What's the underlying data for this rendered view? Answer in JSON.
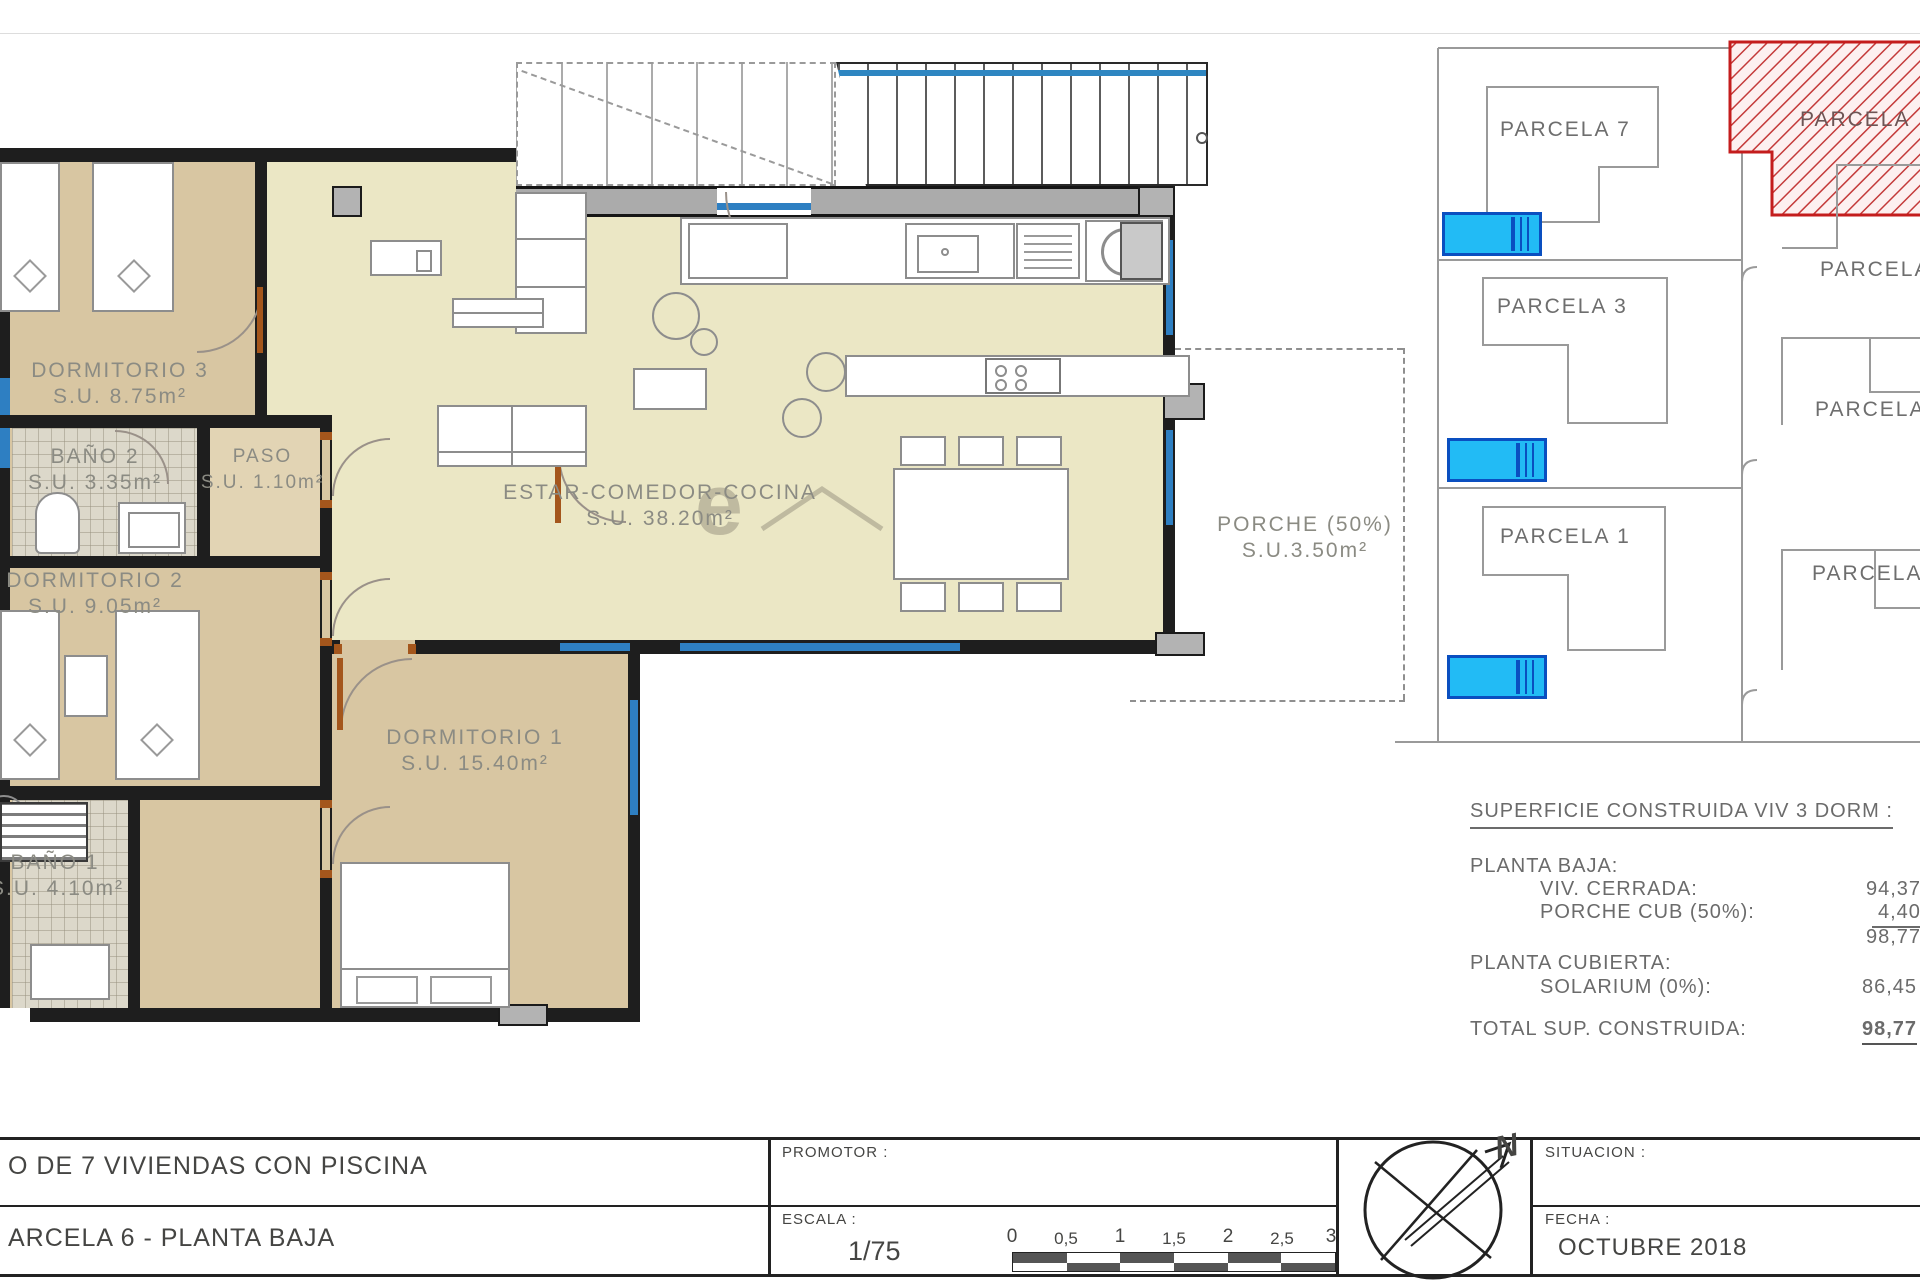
{
  "plan": {
    "rooms": {
      "dorm3": {
        "name": "DORMITORIO 3",
        "area": "S.U. 8.75m²"
      },
      "bano2": {
        "name": "BAÑO 2",
        "area": "S.U. 3.35m²"
      },
      "paso": {
        "name": "PASO",
        "area": "S.U. 1.10m²"
      },
      "dorm2": {
        "name": "DORMITORIO 2",
        "area": "S.U. 9.05m²"
      },
      "estar": {
        "name": "ESTAR-COMEDOR-COCINA",
        "area": "S.U. 38.20m²"
      },
      "porche": {
        "name": "PORCHE (50%)",
        "area": "S.U.3.50m²"
      },
      "dorm1": {
        "name": "DORMITORIO 1",
        "area": "S.U. 15.40m²"
      },
      "bano1": {
        "name": "BAÑO 1",
        "area": "S.U. 4.10m²"
      }
    },
    "watermark": "e"
  },
  "site": {
    "parcela7": "PARCELA 7",
    "parcela3": "PARCELA 3",
    "parcela1": "PARCELA 1",
    "parcela6": "PARCELA",
    "parcela5": "PARCELA",
    "parcela4": "PARCELA 4",
    "parcela2": "PARCELA 2"
  },
  "table": {
    "title": "SUPERFICIE CONSTRUIDA VIV 3 DORM :",
    "planta_baja": "PLANTA BAJA:",
    "viv_cerrada_label": "VIV. CERRADA:",
    "viv_cerrada_value": "94,37",
    "porche_label": "PORCHE CUB (50%):",
    "porche_value": "4,40",
    "subtotal": "98,77",
    "planta_cubierta": "PLANTA CUBIERTA:",
    "solarium_label": "SOLARIUM (0%):",
    "solarium_value": "86,45",
    "total_label": "TOTAL SUP. CONSTRUIDA:",
    "total_value": "98,77"
  },
  "titleblock": {
    "project_line": "O DE 7 VIVIENDAS CON PISCINA",
    "sheet_line": "ARCELA 6 - PLANTA BAJA",
    "promotor": "PROMOTOR :",
    "escala": "ESCALA :",
    "escala_value": "1/75",
    "ticks": [
      "0",
      "0,5",
      "1",
      "1,5",
      "2",
      "2,5",
      "3"
    ],
    "situacion": "SITUACION :",
    "fecha": "FECHA :",
    "fecha_value": "OCTUBRE 2018",
    "north": "N"
  }
}
